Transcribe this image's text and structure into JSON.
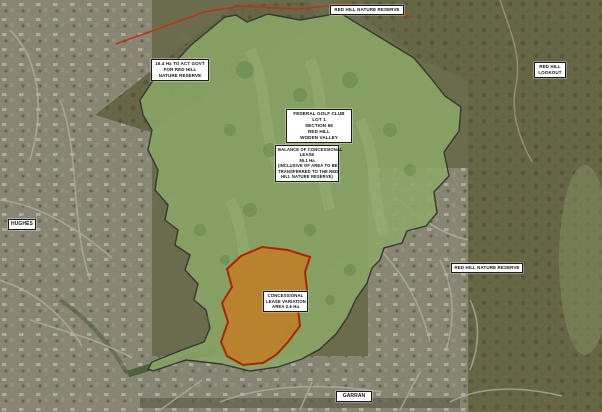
{
  "map": {
    "title": "Federal Golf Club concessional lease variation aerial plan",
    "labels": {
      "top_reserve": "RED HILL NATURE RESERVE",
      "act_govt": [
        "16.4 Ha TO ACT GOVT",
        "FOR RED HILL",
        "NATURE RESERVE"
      ],
      "lookout": [
        "RED HILL",
        "LOOKOUT"
      ],
      "federal": [
        "FEDERAL GOLF CLUB",
        "LOT 1",
        "SECTION 56",
        "RED HILL",
        "WODEN VALLEY"
      ],
      "balance": [
        "BALANCE OF CONCESSIONAL",
        "LEASE",
        "55.1 Ha",
        "(INCLUSIVE OF AREA TO BE",
        "TRANSFERRED TO THE RED",
        "HILL NATURE RESERVE)"
      ],
      "hughes": "HUGHES",
      "right_reserve": "RED HILL NATURE RESERVE",
      "variation": [
        "CONCESSIONAL",
        "LEASE VARIATION",
        "AREA 2.6 Ha"
      ],
      "garran": "GARRAN"
    },
    "colors": {
      "lease_fill": "#a7cb7e",
      "lease_outline": "#45453c",
      "variation_fill": "#e69a31",
      "variation_outline": "#d22c04",
      "reserve_boundary": "#e04414"
    }
  }
}
